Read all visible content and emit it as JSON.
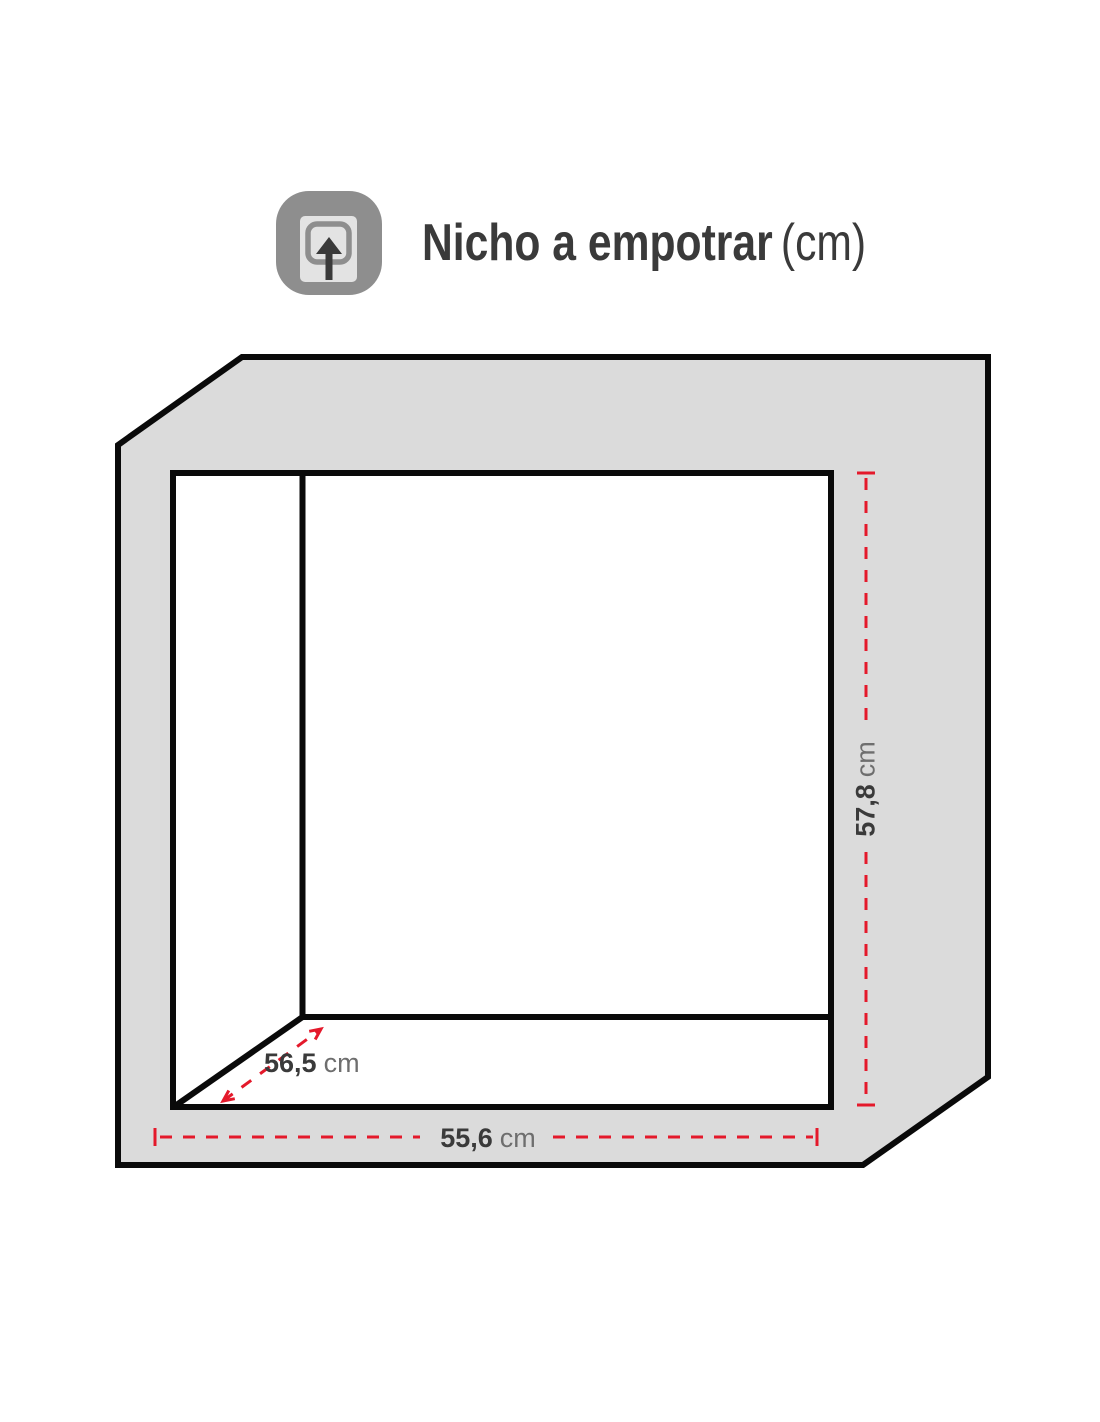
{
  "title": {
    "main": "Nicho a empotrar",
    "suffix": "(cm)"
  },
  "icons": {
    "header_icon": "embed-appliance-arrow-up-icon"
  },
  "diagram": {
    "type": "niche-dimension-drawing",
    "dimensions": {
      "height": {
        "value": "57,8",
        "unit": "cm"
      },
      "width": {
        "value": "55,6",
        "unit": "cm"
      },
      "depth": {
        "value": "56,5",
        "unit": "cm"
      }
    }
  },
  "colors": {
    "accent_red": "#e4192b",
    "wall_gray": "#dbdbdb",
    "line_black": "#0a0a0a",
    "icon_gray": "#8e8e8e",
    "icon_light": "#e3e3e3",
    "text_dark": "#3a3a3a",
    "text_unit": "#6e6e6e"
  }
}
